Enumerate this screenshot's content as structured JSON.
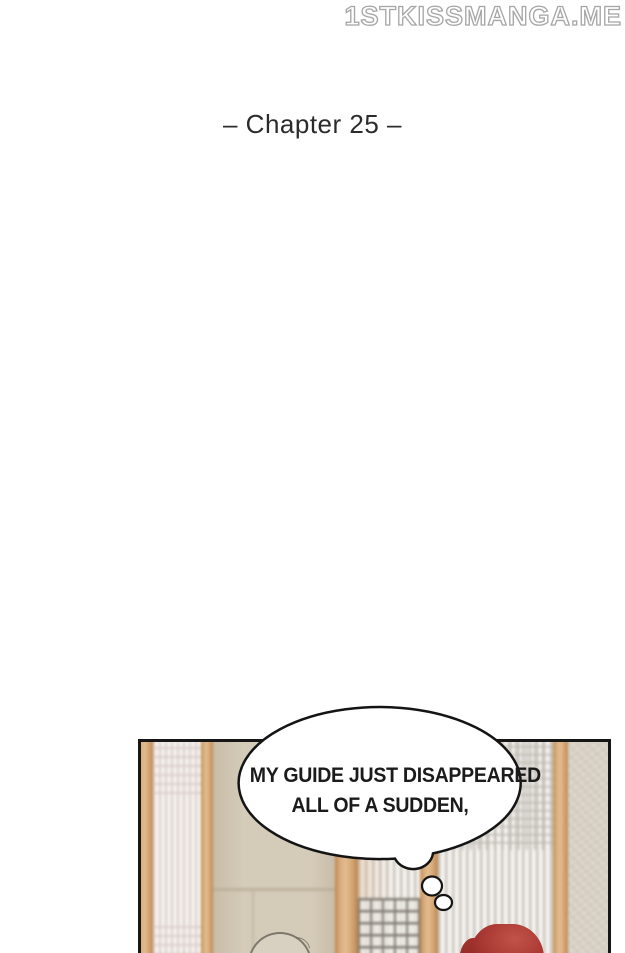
{
  "page": {
    "watermark": "1STKISSMANGA.ME",
    "chapter_title": "– Chapter 25 –"
  },
  "panel": {
    "description": "manga panel of a traditional room with shoji screens and wood posts, two characters seen from above at bottom edge",
    "bubble": {
      "type": "thought-bubble",
      "line1": "MY GUIDE JUST DISAPPEARED",
      "line2": "ALL OF A SUDDEN,"
    }
  },
  "colors": {
    "page_bg": "#ffffff",
    "title_text": "#2b2b2b",
    "watermark_fill": "#ffffff",
    "watermark_outline": "#a6a6a6",
    "panel_border": "#161616",
    "bubble_outline": "#141414",
    "bubble_fill": "#ffffff",
    "bubble_text": "#1b1b1b",
    "wood_light": "#e3bd92",
    "wood_mid": "#d7a876",
    "wood_dark": "#b9854f",
    "shoji_base": "#f5f2ee",
    "shoji_stripe_pink": "#dbcfcc",
    "shoji_stripe_gray": "#c9c4be",
    "lattice_dark": "#827d75",
    "lattice_fine": "#bdb8b2",
    "wall_beige": "#d4cbb8",
    "wall_beige_dark": "#c8bda9",
    "wall_right": "#d8d2c6",
    "seam": "#b7ac97",
    "head_line": "#5f5a4e",
    "head_fill": "#d8d1c2",
    "hair_red": "#a5352f",
    "hair_red_light": "#c25349",
    "hair_red_dark": "#7e231f"
  }
}
